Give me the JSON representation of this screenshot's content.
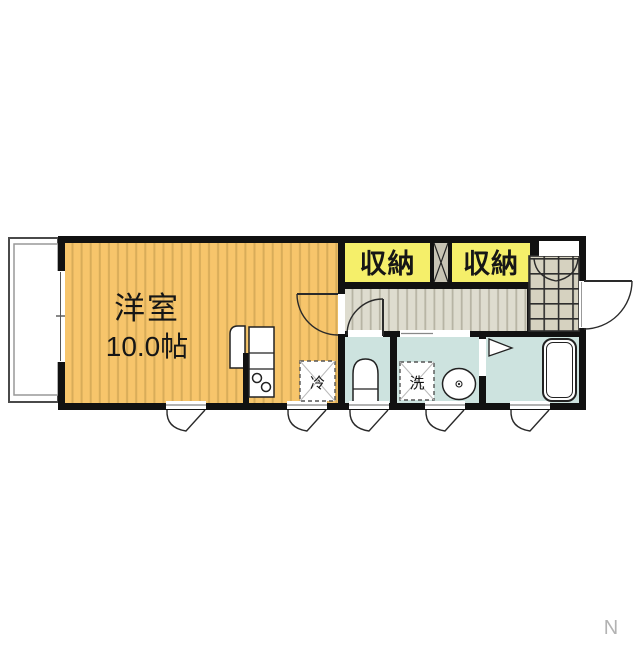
{
  "colors": {
    "wall": "#111111",
    "room": "#F7C56B",
    "room-stripe": "#D8AC59",
    "closet": "#F5EF6A",
    "hall": "#DEDCCF",
    "hall-stripe": "#B7B4A4",
    "tile": "#D6D2C0",
    "tile-line": "#2e2e2e",
    "wet": "#CDE3DF",
    "line": "#222222",
    "muted": "#b3b3b3"
  },
  "floor_plan": {
    "main_room": {
      "label": "洋室",
      "size_label": "10.0帖"
    },
    "closets": [
      {
        "label": "収納"
      },
      {
        "label": "収納"
      }
    ],
    "refrigerator_space": {
      "label": "冷"
    },
    "washing_machine_space": {
      "label": "洗"
    },
    "compass": {
      "label": "N"
    }
  }
}
